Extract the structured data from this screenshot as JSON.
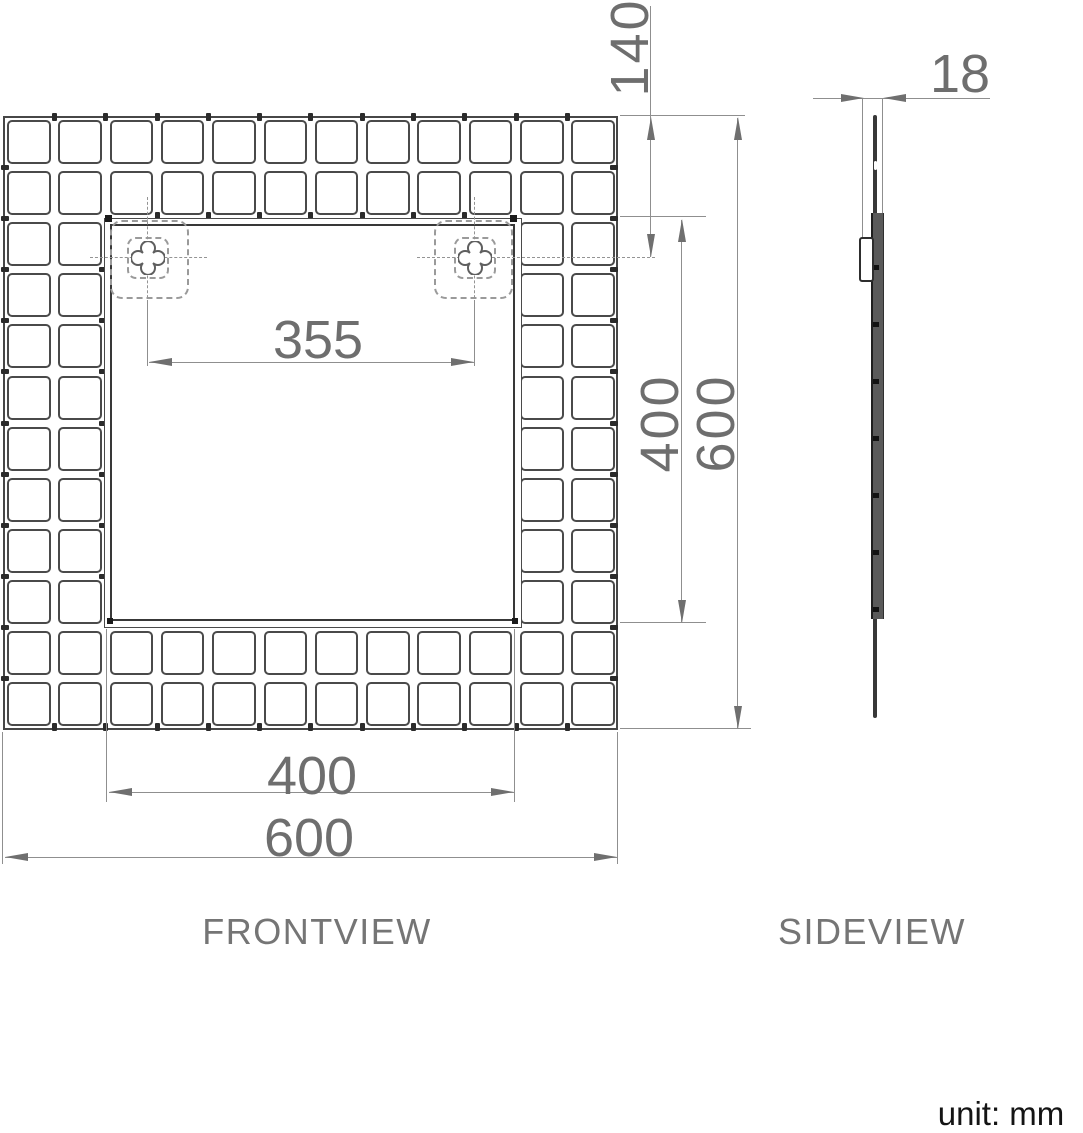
{
  "front_view": {
    "label": "FRONTVIEW",
    "dimensions": {
      "hole_spacing": "355",
      "hole_offset_top": "140",
      "opening_width": "400",
      "opening_height": "400",
      "overall_width": "600",
      "overall_height": "600"
    },
    "mosaic": {
      "rows": 12,
      "cols": 12,
      "border_rings": 2
    }
  },
  "side_view": {
    "label": "SIDEVIEW",
    "dimensions": {
      "thickness": "18"
    }
  },
  "unit_note": "unit: mm",
  "colors": {
    "tile_line": "#4a4a4a",
    "dim_line": "#8f8f8f",
    "arrow": "#6f6f6f",
    "dim_text": "#6e6e6e",
    "label_text": "#757575",
    "unit_text": "#141414",
    "bar_fill": "#5a5a5a"
  }
}
